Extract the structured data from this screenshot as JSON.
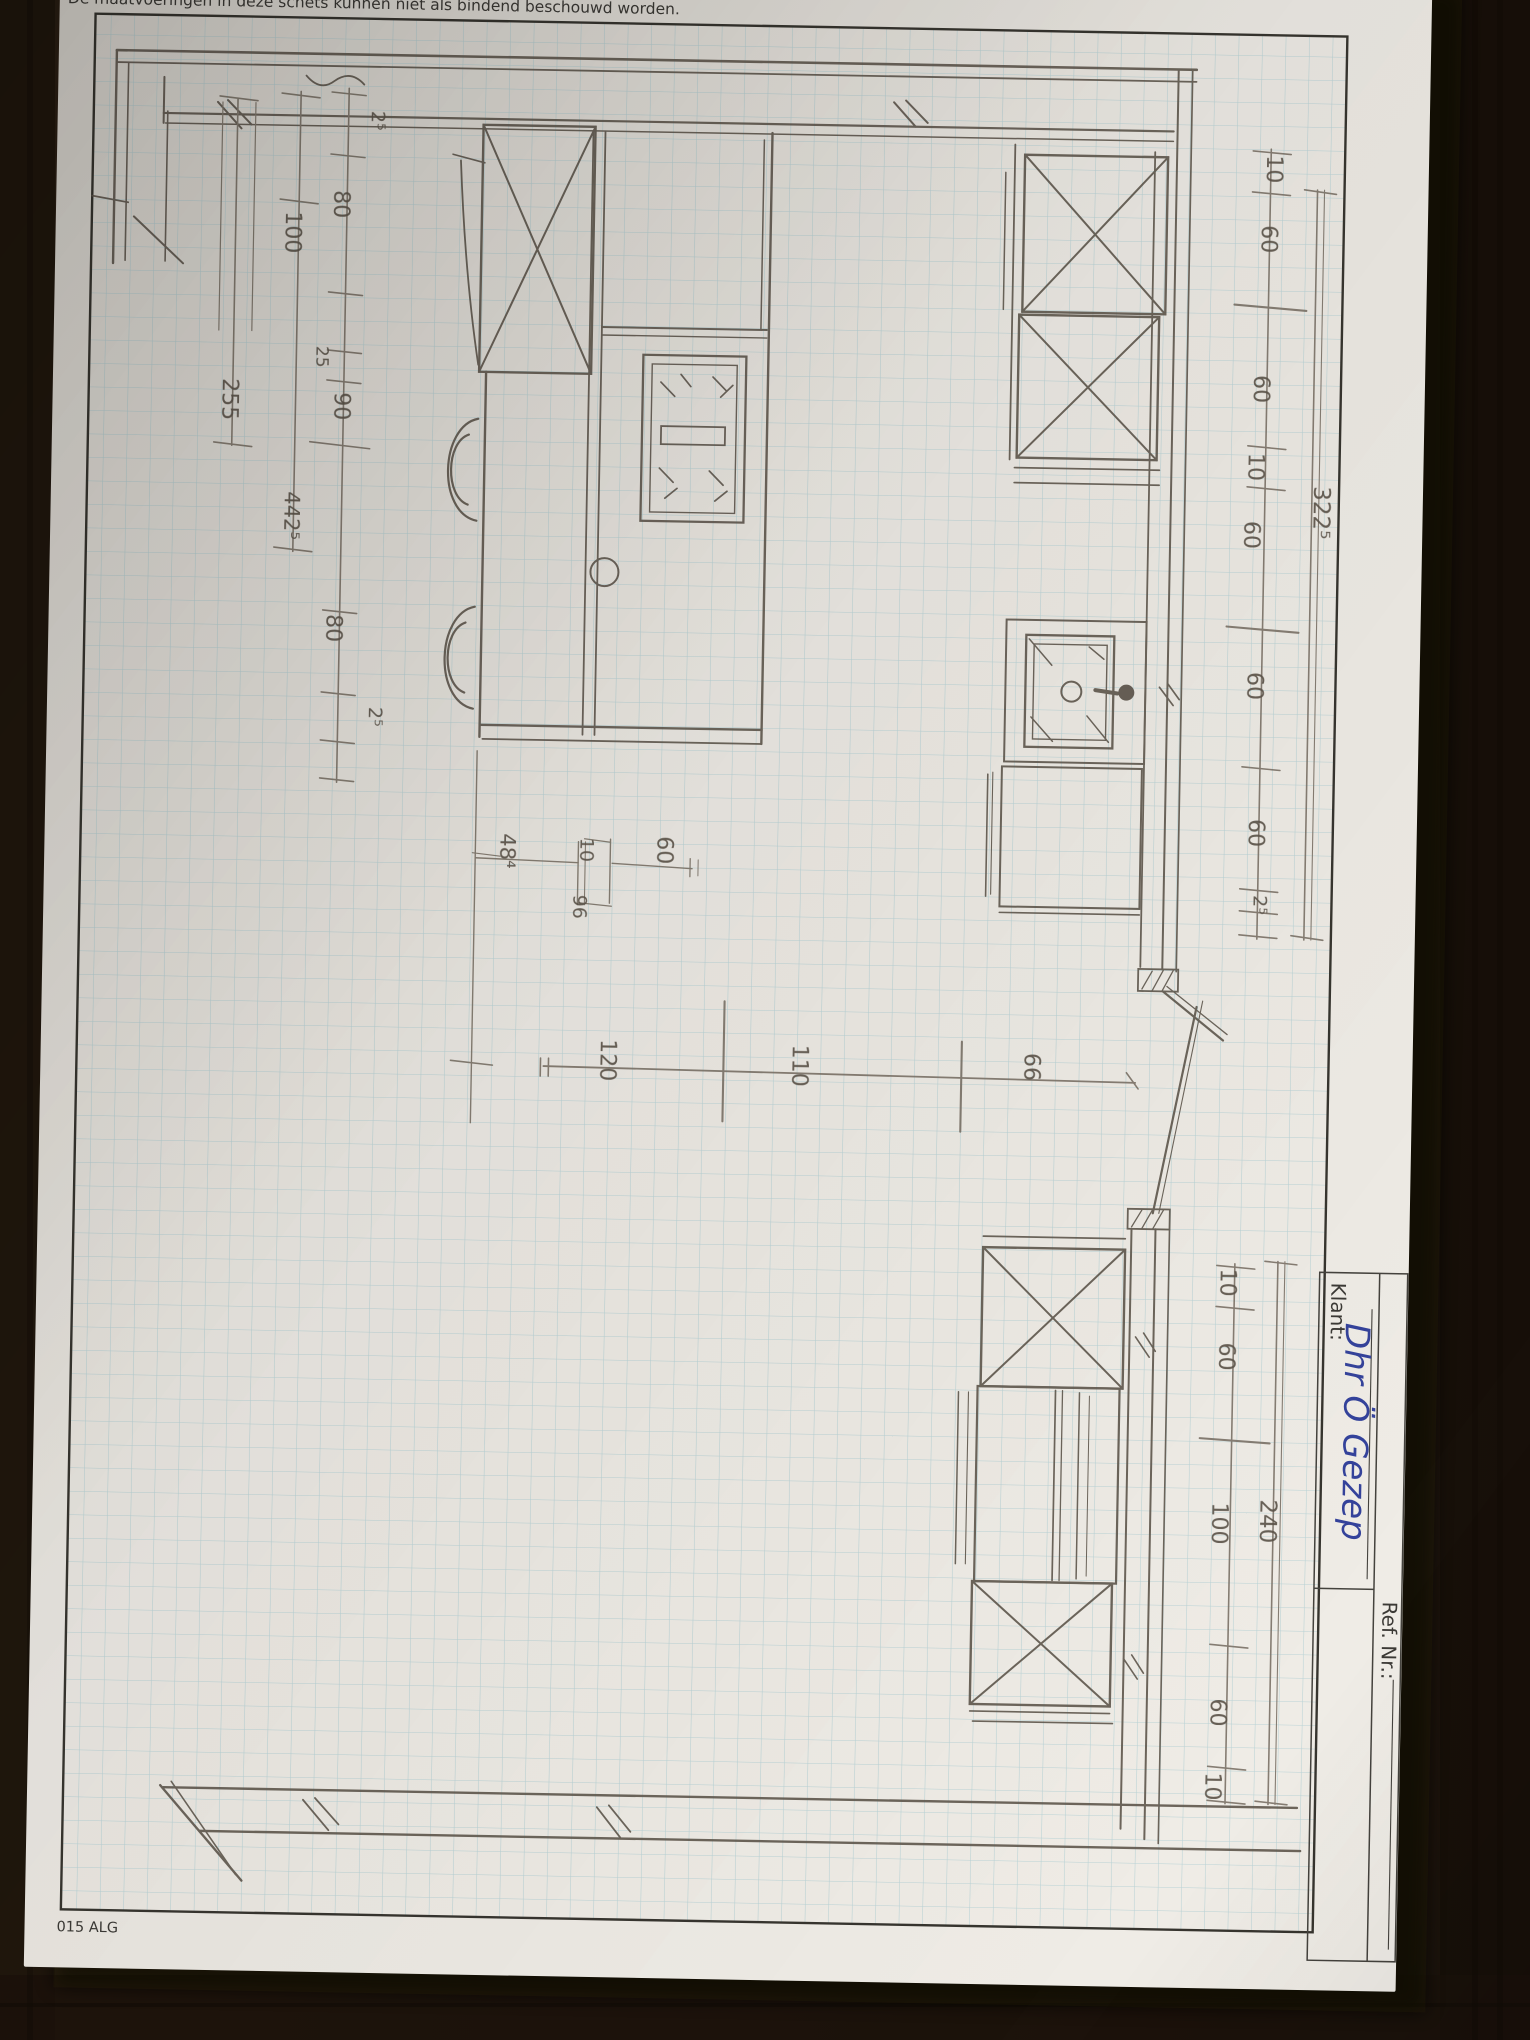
{
  "photo": {
    "description": "Photograph of a hand-drawn kitchen floor plan sketched in pencil on blue graph paper, on a dark wooden table",
    "colors": {
      "wood": "#281d13",
      "paper": "#ece9e3",
      "grid_line": "#a3c8cf",
      "pencil": "#5f574d",
      "pen_blue": "#35439b",
      "printed_frame": "#35332e"
    }
  },
  "form": {
    "header_disclaimer": "De maatvoeringen in deze schets kunnen niet als bindend beschouwd worden.",
    "footer_code": "015 ALG",
    "client_label": "Klant:",
    "client_value": "Dhr Ö Gezep",
    "ref_label": "Ref. Nr.:"
  },
  "sketch": {
    "dims": {
      "right_top": [
        "10",
        "60",
        "60",
        "10",
        "60",
        "60",
        "60",
        "2⁵"
      ],
      "right_top_total": "322⁵",
      "left": [
        "2⁵",
        "80",
        "100",
        "25",
        "90",
        "255",
        "442⁵",
        "80",
        "2⁵"
      ],
      "middle": [
        "48⁴",
        "10",
        "96",
        "60"
      ],
      "floor": [
        "120",
        "110",
        "66"
      ],
      "right_bottom": [
        "10",
        "60",
        "100",
        "60",
        "10"
      ],
      "right_bottom_total": "240"
    }
  }
}
